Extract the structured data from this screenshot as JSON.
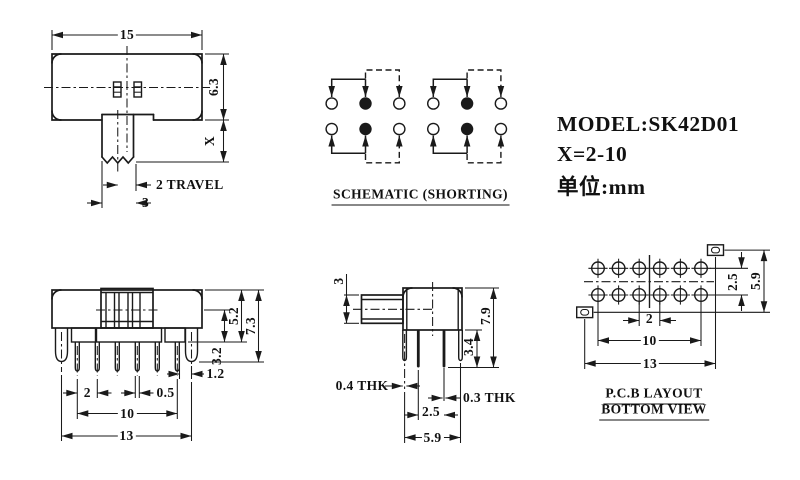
{
  "colors": {
    "ink": "#1a1a1a",
    "paper": "#ffffff"
  },
  "title_block": {
    "model": "MODEL:SK42D01",
    "x_range": "X=2-10",
    "unit": "单位:mm"
  },
  "top_view": {
    "width": "15",
    "height": "6.3",
    "stem_extension": "X",
    "travel": "2 TRAVEL",
    "stem_width": "3"
  },
  "schematic": {
    "caption": "SCHEMATIC (SHORTING)"
  },
  "front_view": {
    "body_height": "5.2",
    "overall_height": "7.3",
    "pin_length": "3.2",
    "lug_offset": "1.2",
    "pin_pitch": "2",
    "pin_width": "0.5",
    "pin_span": "10",
    "lug_span": "13"
  },
  "side_view": {
    "stem_height": "3",
    "overall_height": "7.9",
    "pin_length": "3.4",
    "lug_thickness": "0.4 THK",
    "pin_thickness": "0.3 THK",
    "row_spacing": "2.5",
    "leg_spacing": "5.9"
  },
  "pcb_view": {
    "row_spacing": "2.5",
    "slot_spacing_v": "5.9",
    "pad_pitch": "2",
    "pad_span": "10",
    "slot_spacing_h": "13",
    "caption_line1": "P.C.B LAYOUT",
    "caption_line2": "BOTTOM VIEW"
  }
}
